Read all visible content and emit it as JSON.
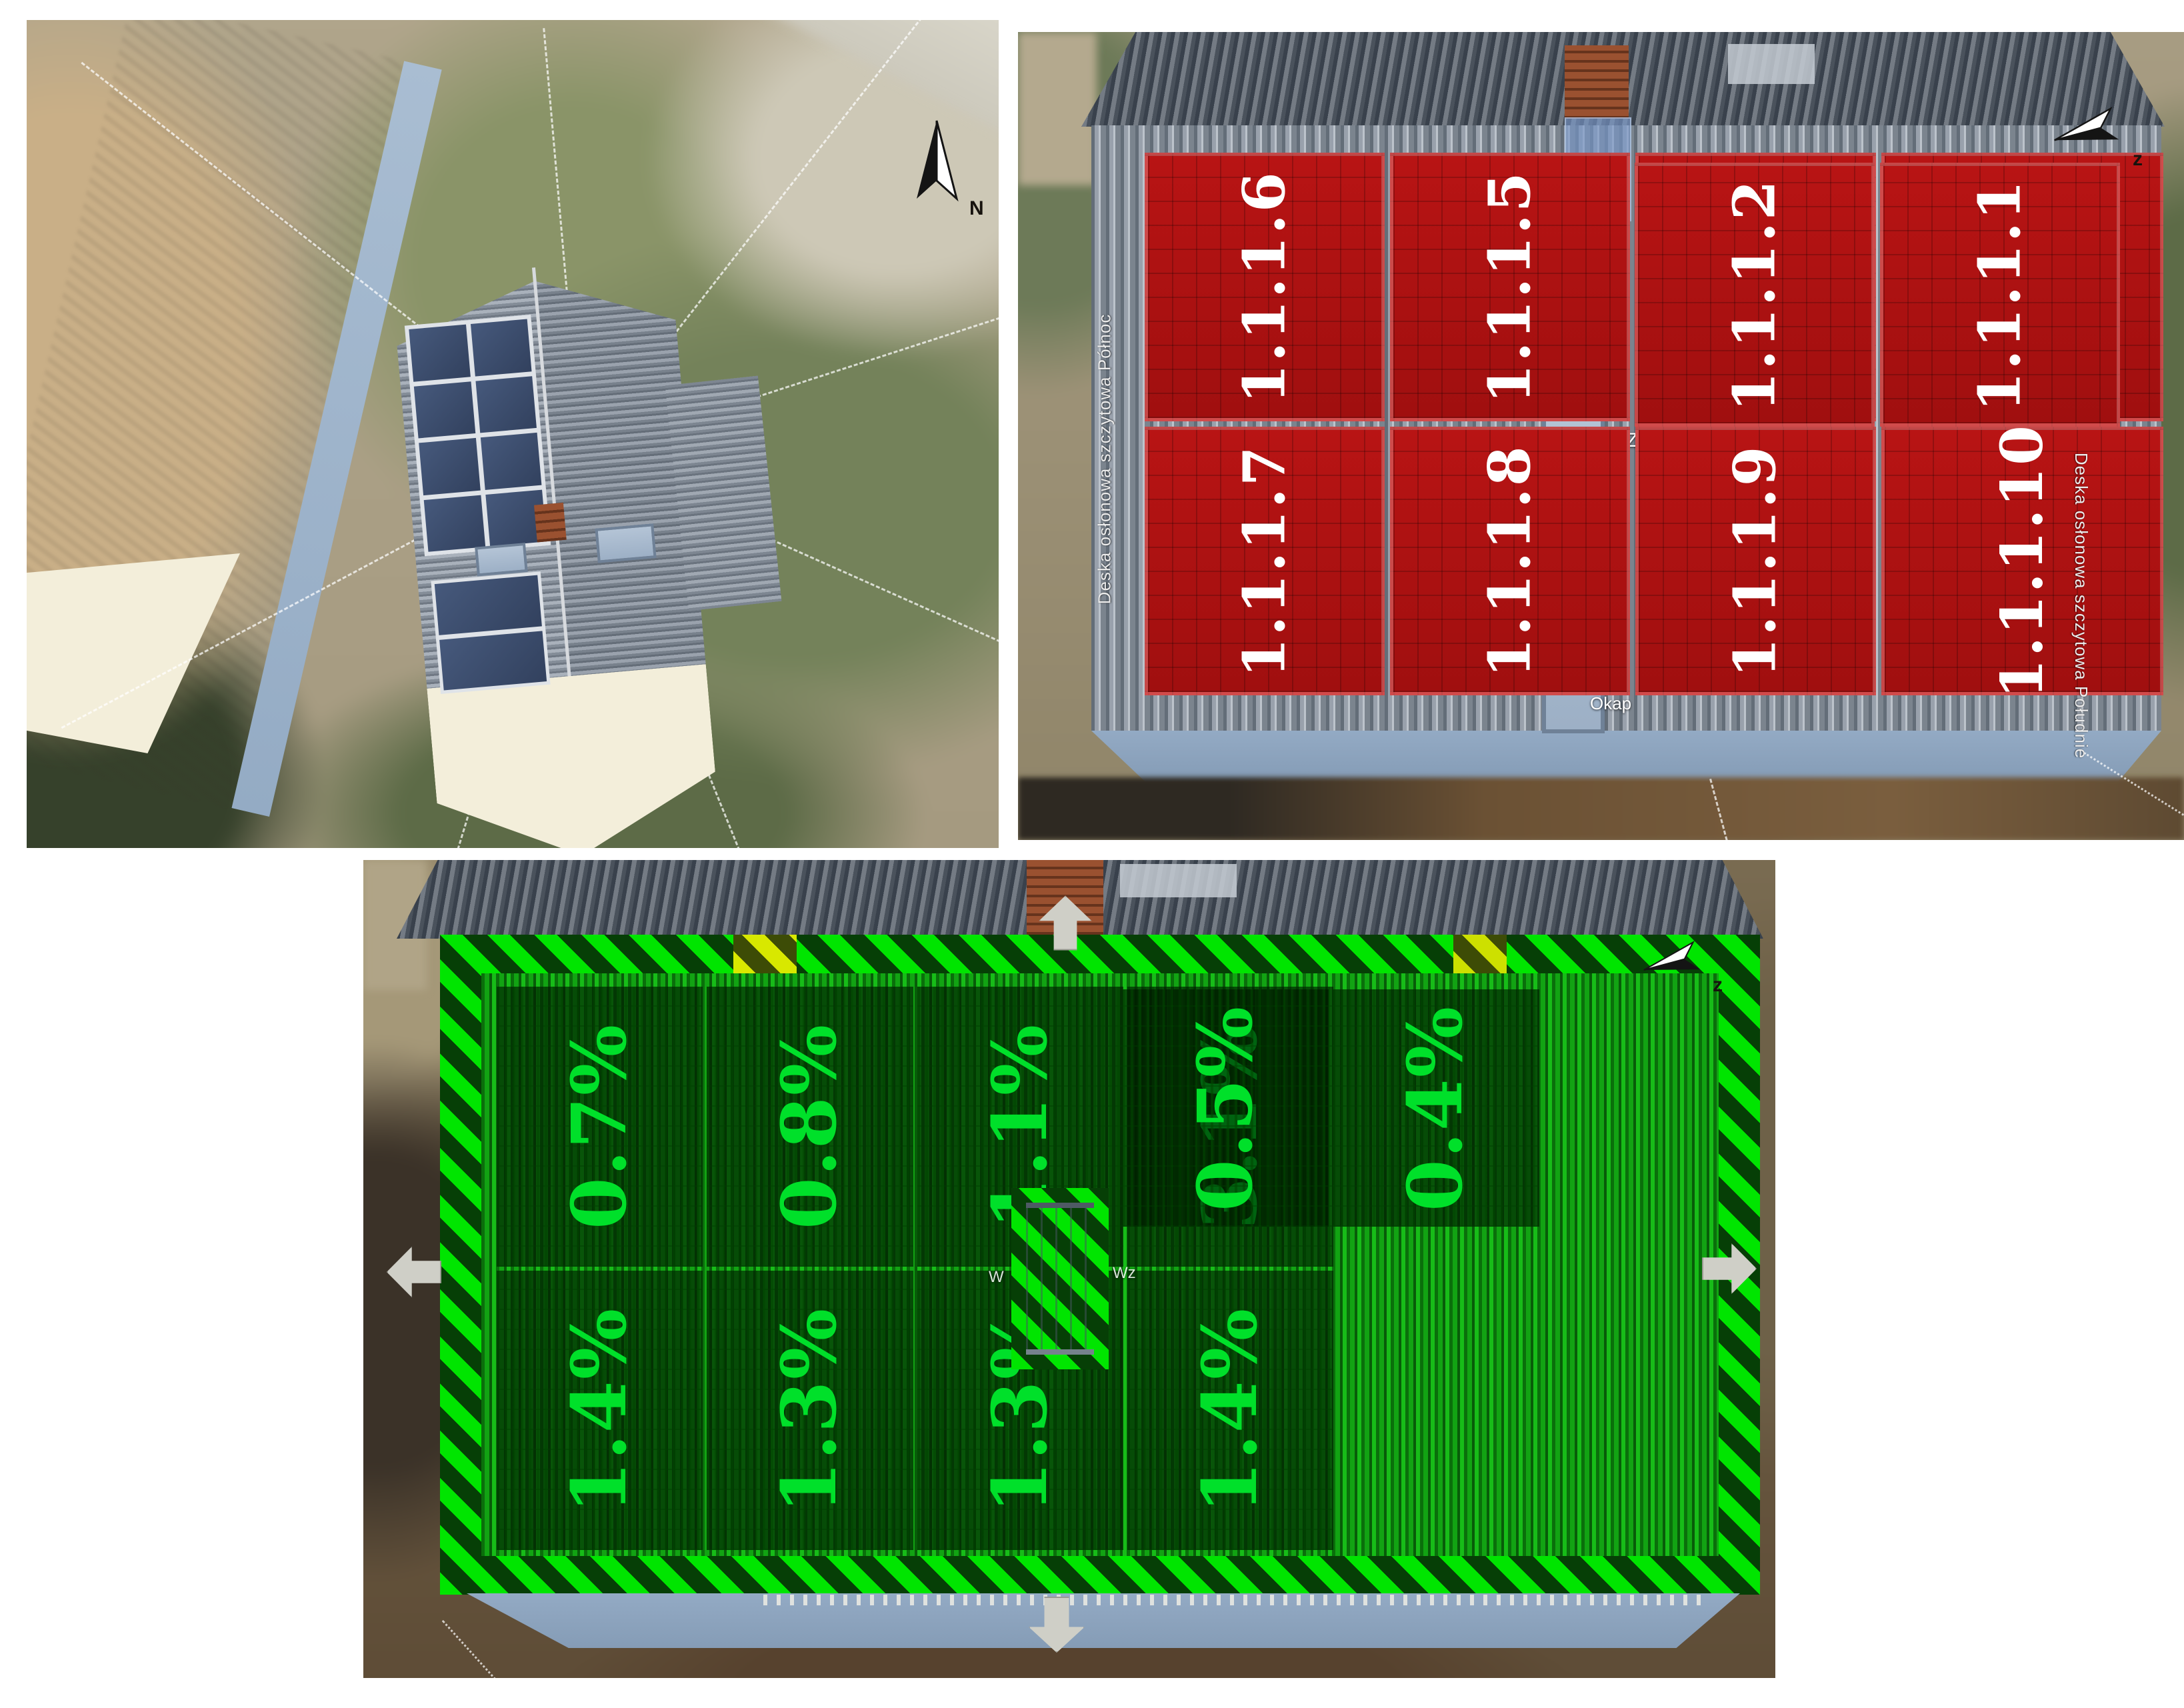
{
  "app": {
    "background_color": "#ffffff"
  },
  "view_overview": {
    "title": "3d-satellite-overview",
    "compass_label": "N"
  },
  "view_west_roof": {
    "title": "west-roof-module-numbering",
    "compass_label": "z",
    "module_color": "#b11212",
    "module_text_color": "#ffffff",
    "labels": {
      "ridge": "Kalenica",
      "eaves": "Okap",
      "roof_hatch": "Wlot dachu, Zachód",
      "gable_board_north": "Deska osłonowa szczytowa Północ",
      "gable_board_south": "Deska osłonowa szczytowa Południe"
    },
    "module_rows": {
      "top": [
        "1.1.1.6",
        "1.1.1.5",
        "1.1.1.4",
        "1.1.1.3"
      ],
      "bottom": [
        "1.1.1.7",
        "1.1.1.8",
        "1.1.1.9",
        "1.1.1.10"
      ],
      "right": [
        "1.1.1.2",
        "1.1.1.1"
      ]
    }
  },
  "view_shading": {
    "title": "roof-shading-percentages",
    "compass_label": "z",
    "value_color": "#00e02a",
    "roof_color": "#12a313",
    "hatch_color": "#00e500",
    "shading_rows": {
      "top": [
        "0.7%",
        "0.8%",
        "1.1%",
        "3.1%"
      ],
      "bottom": [
        "1.4%",
        "1.3%",
        "1.3%",
        "1.4%"
      ],
      "right": [
        "0.5%",
        "0.4%"
      ]
    },
    "partial_labels": {
      "left": "W",
      "right": "Wz"
    }
  }
}
